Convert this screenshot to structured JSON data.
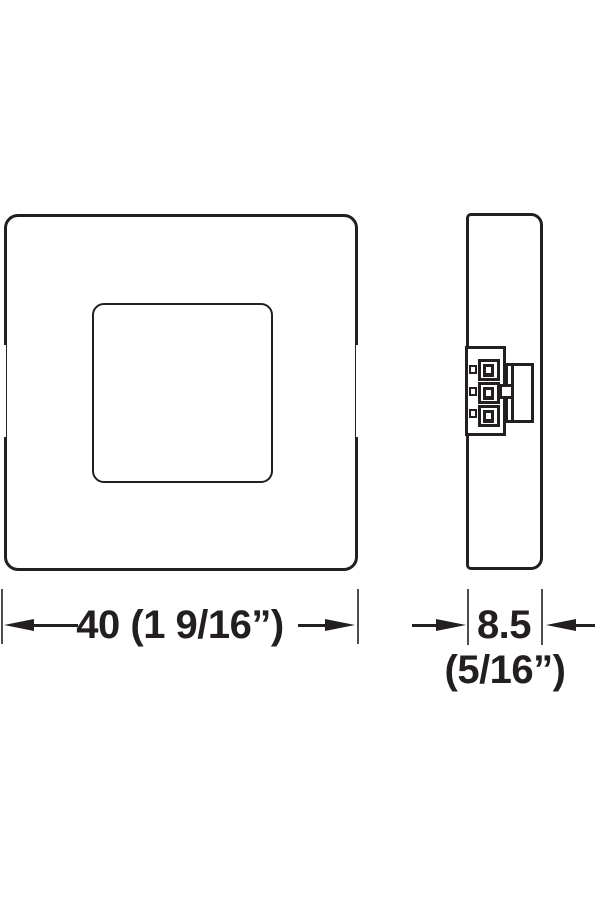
{
  "drawing": {
    "kind": "technical-dimension-drawing",
    "views": {
      "front": "front-view",
      "side": "side-view-with-terminal-connector"
    },
    "dimensions": {
      "width": {
        "label": "40 (1 9/16”)"
      },
      "depth": {
        "label": "8.5",
        "sublabel": "(5/16”)"
      }
    },
    "colors": {
      "line": "#231f20",
      "extension_line": "#4d4d4f",
      "background": "#ffffff"
    }
  }
}
